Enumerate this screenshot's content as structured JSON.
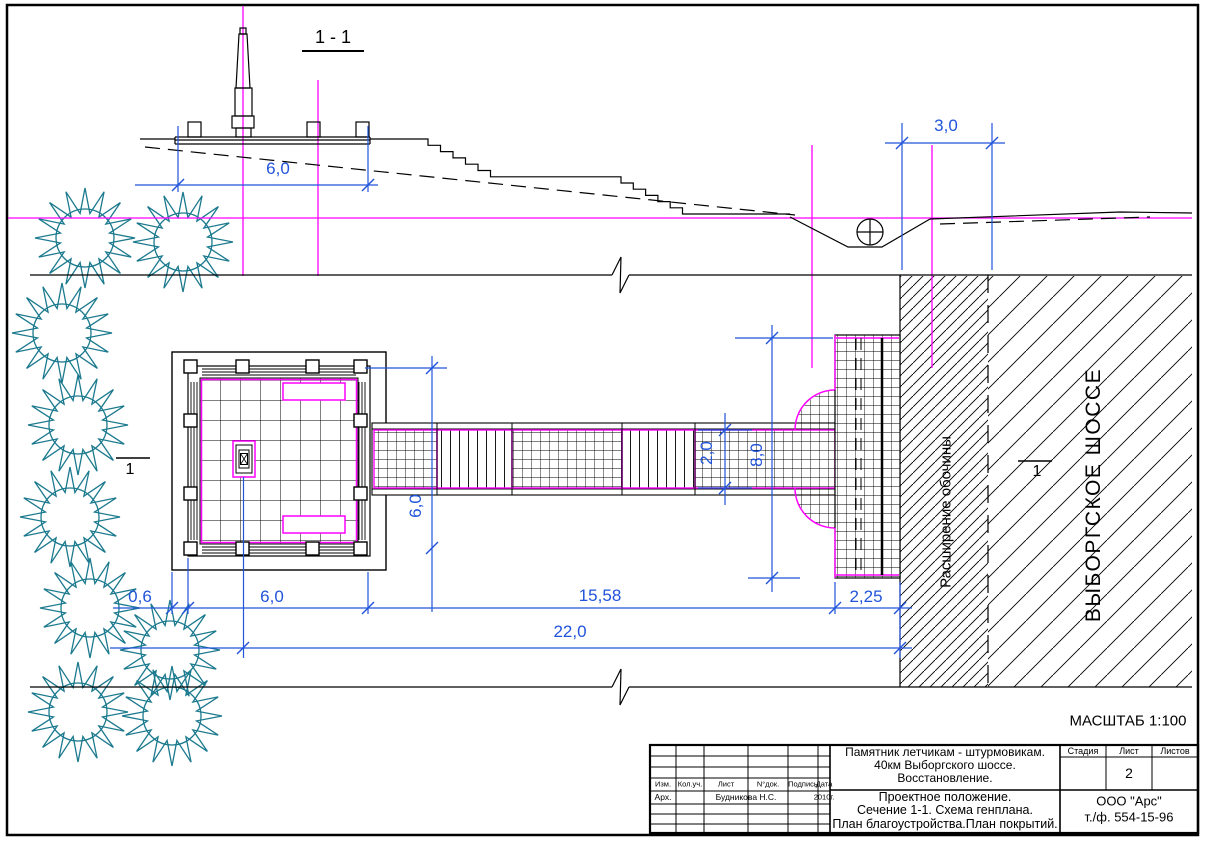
{
  "drawing": {
    "scale_label": "МАСШТАБ 1:100",
    "section": {
      "title": "1 - 1",
      "dim_platform": "6,0",
      "dim_ditch": "3,0"
    },
    "plan": {
      "dim_edge": "0,6",
      "dim_square": "6,0",
      "dim_walkway": "15,58",
      "dim_shoulder": "2,25",
      "dim_total": "22,0",
      "dim_square_side": "6,0",
      "dim_walkway_width": "2,0",
      "dim_pad_length": "8,0",
      "label_shoulder": "Расширение обочины",
      "label_road": "ВЫБОРГСКОЕ ШОССЕ",
      "section_mark_left": "1",
      "section_mark_right": "1"
    }
  },
  "title_block": {
    "project_lines": [
      "Памятник летчикам - штурмовикам.",
      "40км Выборгского шоссе.",
      "Восстановление."
    ],
    "content_lines": [
      "Проектное положение.",
      "Сечение 1-1. Схема генплана.",
      "План благоустройства.План покрытий."
    ],
    "header_cols": [
      "Изм.",
      "Кол.уч.",
      "Лист",
      "N°док.",
      "Подпись",
      "Дата"
    ],
    "row_role": "Арх.",
    "row_name": "Будникова Н.С.",
    "row_date": "2010г.",
    "stage_cols": [
      "Стадия",
      "Лист",
      "Листов"
    ],
    "sheet_number": "2",
    "company": "ООО \"Арс\"",
    "phone": "т./ф. 554-15-96"
  },
  "colors": {
    "dimension_blue": "#2154db",
    "magenta": "#ff00ff",
    "tree_teal": "#1c7a8e",
    "line_black": "#000000"
  }
}
